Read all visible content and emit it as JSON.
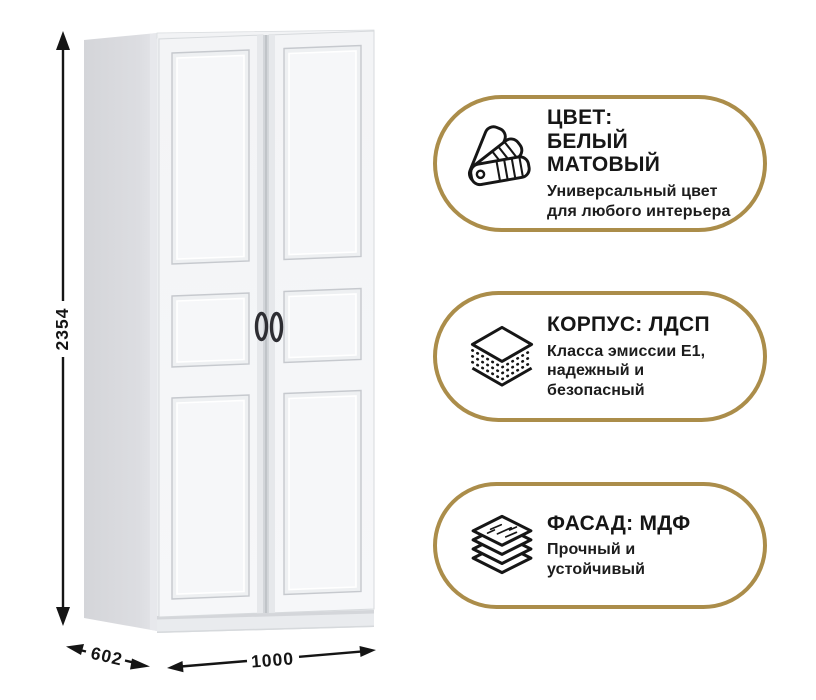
{
  "product": {
    "type": "wardrobe-two-door"
  },
  "dimensions": {
    "height": "2354",
    "depth": "602",
    "width": "1000"
  },
  "badges": [
    {
      "icon": "color-swatches-icon",
      "title1": "ЦВЕТ:",
      "title2": "БЕЛЫЙ МАТОВЫЙ",
      "desc1": "Универсальный цвет",
      "desc2": "для любого интерьера"
    },
    {
      "icon": "layered-board-icon",
      "title1": "КОРПУС: ЛДСП",
      "desc1": "Класса эмиссии Е1,",
      "desc2": "надежный и",
      "desc3": "безопасный"
    },
    {
      "icon": "stacked-sheets-icon",
      "title1": "ФАСАД: МДФ",
      "desc1": "Прочный и",
      "desc2": "устойчивый"
    }
  ],
  "colors": {
    "accent_gold": "#AB8D4A",
    "text": "#1A1A1A",
    "side_panel": "#D8D9DD",
    "door_face": "#F5F6F8"
  }
}
